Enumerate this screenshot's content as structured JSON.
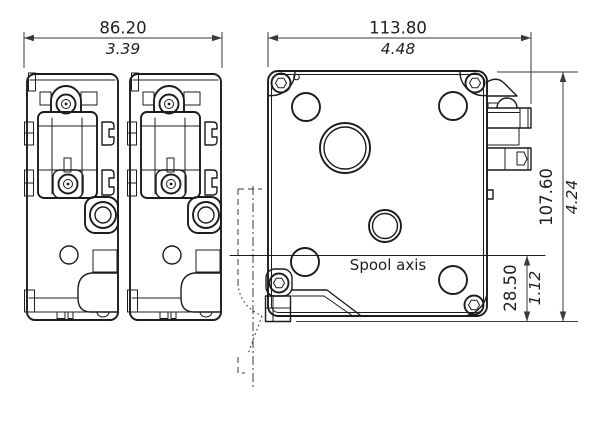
{
  "drawing": {
    "labels": {
      "spool_axis": "Spool axis"
    },
    "dimensions": {
      "side_views_width": {
        "mm": "86.20",
        "inch": "3.39"
      },
      "front_view_width": {
        "mm": "113.80",
        "inch": "4.48"
      },
      "overall_height": {
        "mm": "107.60",
        "inch": "4.24"
      },
      "spool_axis_offset": {
        "mm": "28.50",
        "inch": "1.12"
      }
    },
    "colors": {
      "part_line": "#1c1c1c",
      "dimension_line": "#3a3a3a",
      "background": "#ffffff"
    }
  }
}
